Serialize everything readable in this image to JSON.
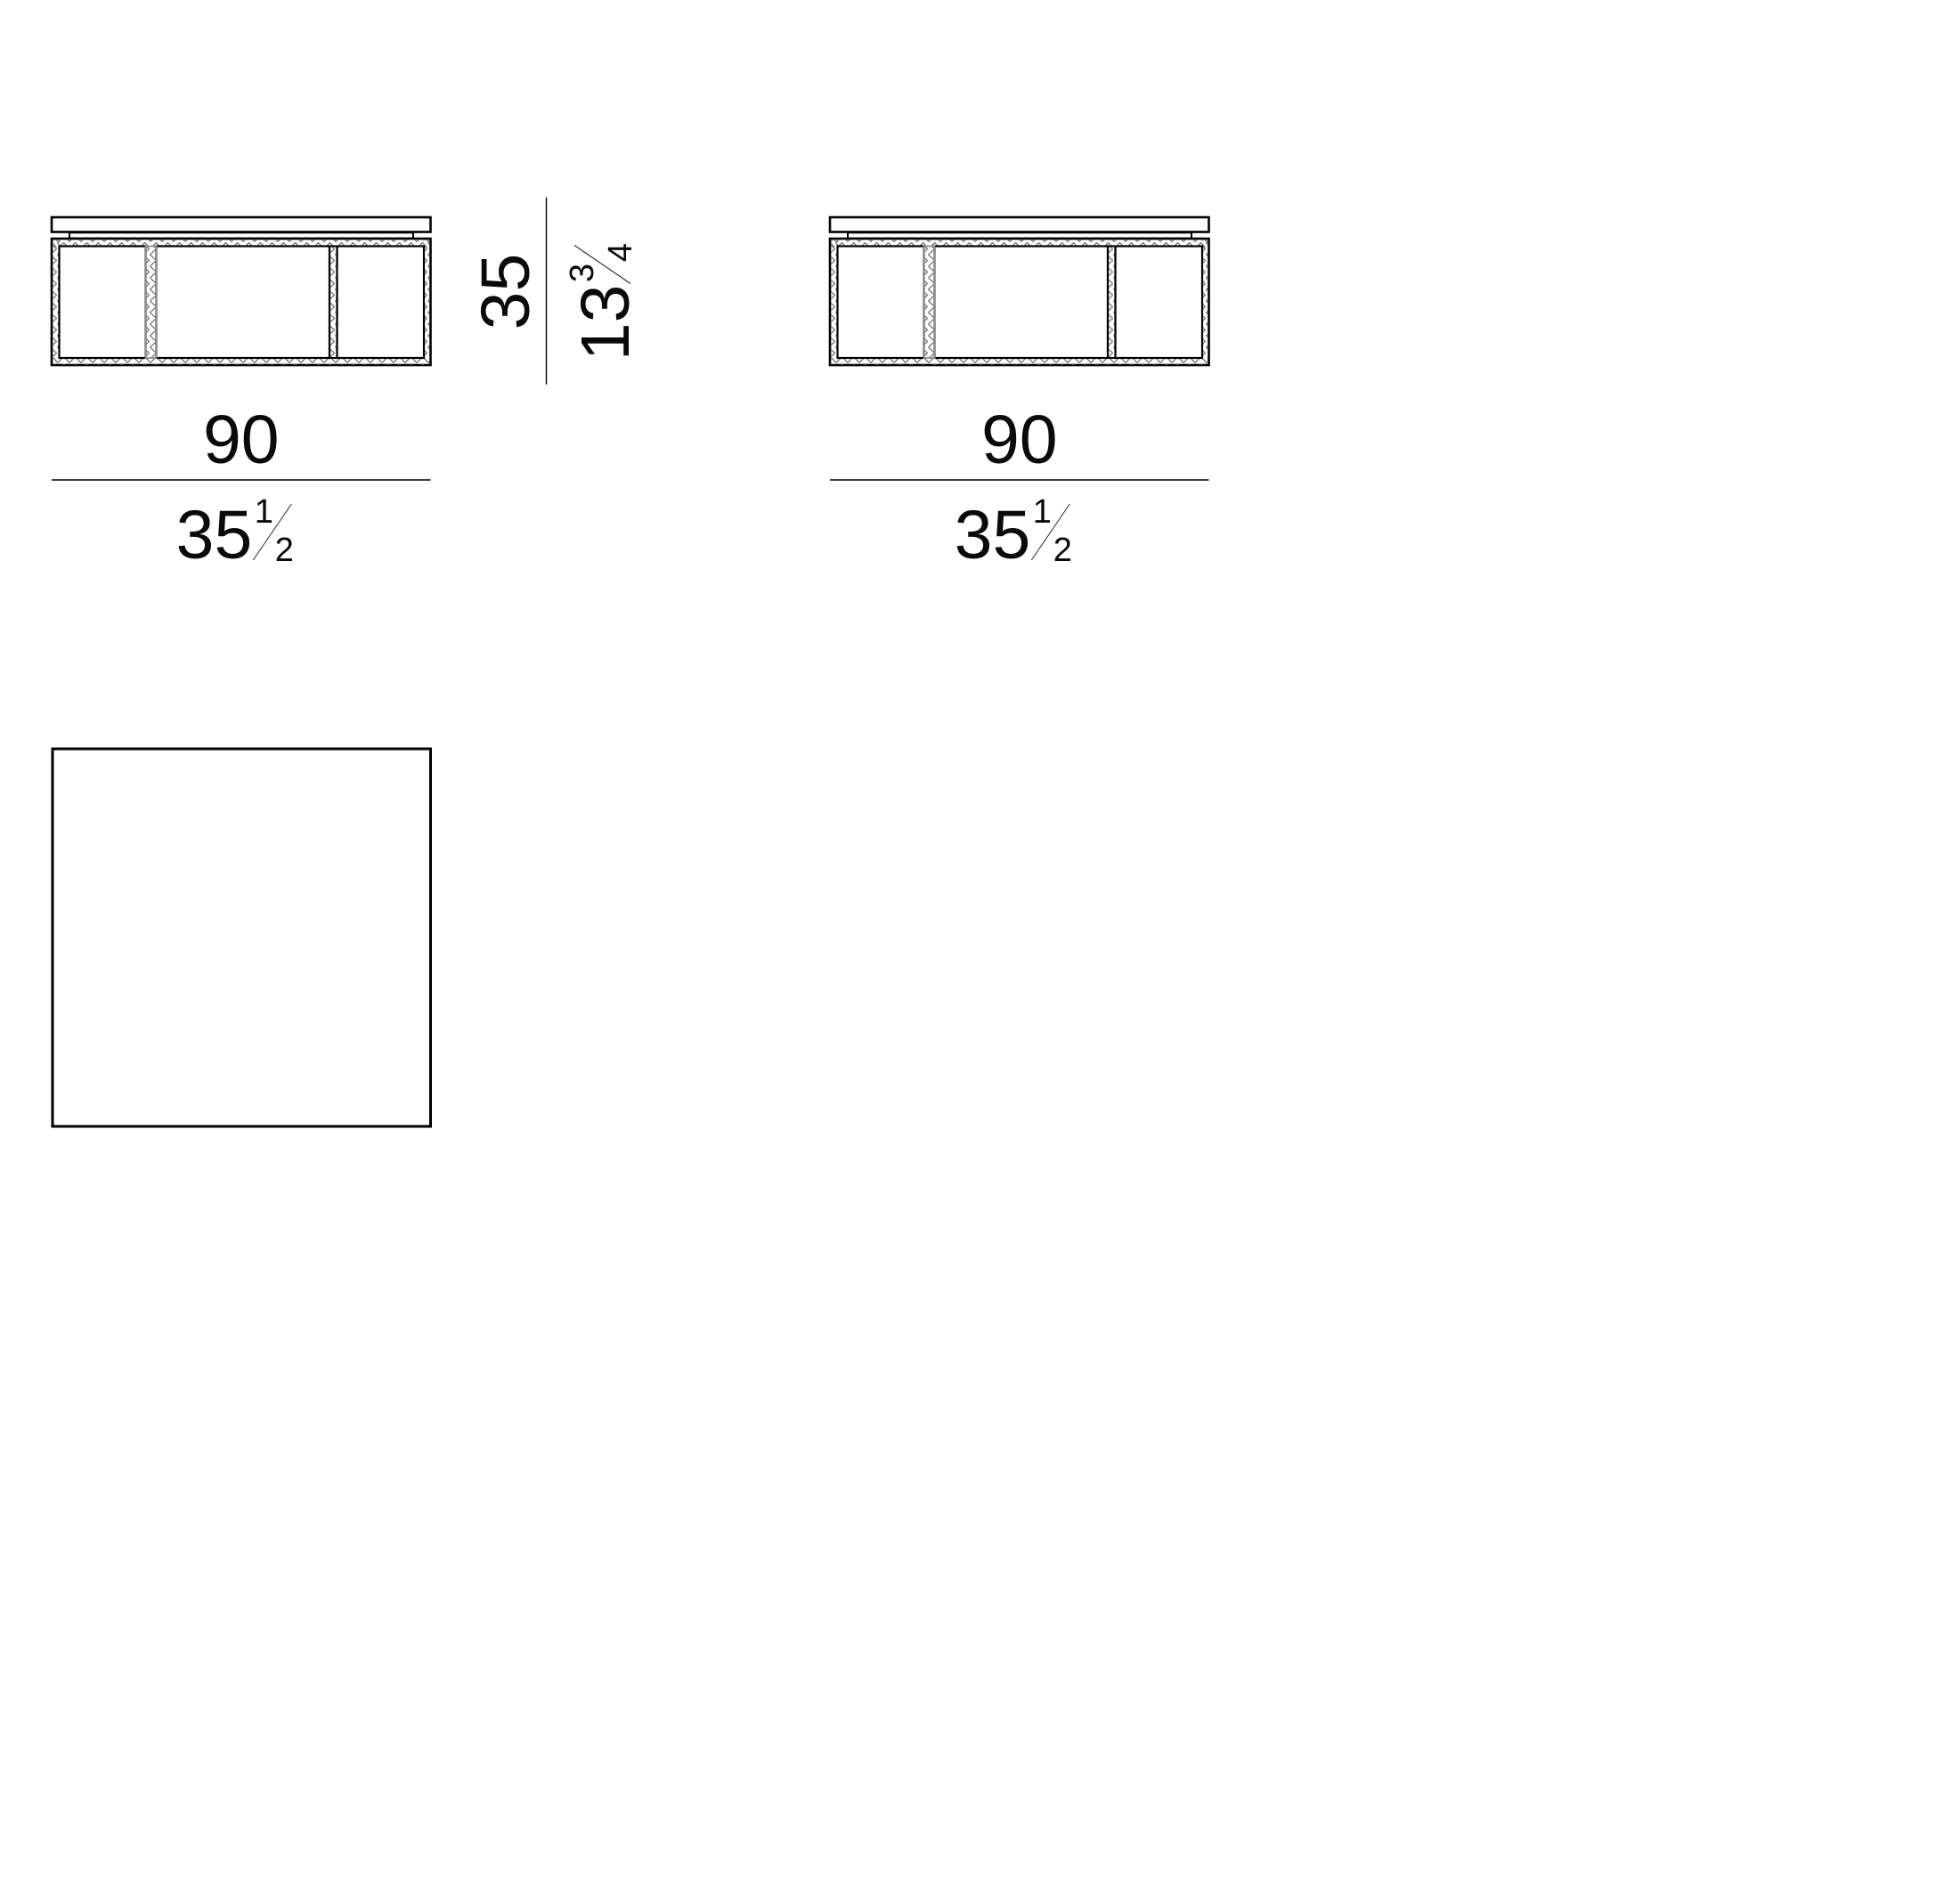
{
  "diagram": {
    "background": "#ffffff",
    "line_color": "#000000",
    "hatch_color": "#838383",
    "gray_divider_color": "#8e8e8e",
    "dimensions": {
      "width_left": {
        "cm": "90",
        "in_whole": "35",
        "in_num": "1",
        "in_den": "2"
      },
      "width_right": {
        "cm": "90",
        "in_whole": "35",
        "in_num": "1",
        "in_den": "2"
      },
      "height": {
        "cm": "35",
        "in_whole": "13",
        "in_num": "3",
        "in_den": "4"
      }
    }
  }
}
